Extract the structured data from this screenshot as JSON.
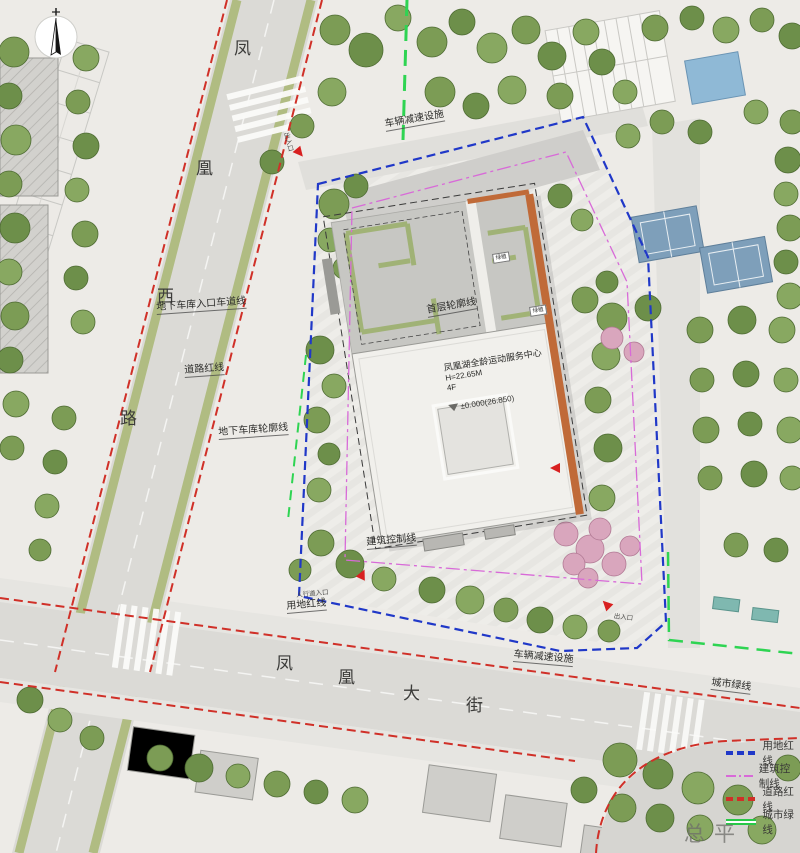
{
  "title": {
    "text": "总平面图",
    "scale": "1:500"
  },
  "roads": {
    "west": [
      "凤",
      "凰",
      "西",
      "路"
    ],
    "south": [
      "凤",
      "凰",
      "大",
      "街"
    ]
  },
  "building": {
    "name": "凤凰湖全龄运动服务中心",
    "height": "H=22.65M",
    "floors": "4F",
    "elevation": "±0.000(26.850)",
    "roof_labels": [
      "绿植",
      "绿植"
    ]
  },
  "annotations": {
    "speed_bump_top": "车辆减速设施",
    "garage_entry_lane": "地下车库入口车道线",
    "road_red_line": "道路红线",
    "garage_outline": "地下车库轮廓线",
    "first_floor_outline": "首层轮廓线",
    "building_control_line": "建筑控制线",
    "pedestrian_entry": "人行道入口",
    "site_red_line": "用地红线",
    "speed_bump_bottom": "车辆减速设施",
    "city_green_line": "城市绿线",
    "entrance": "出入口"
  },
  "legend": {
    "items": [
      {
        "label": "用地红线",
        "color": "#2038c8"
      },
      {
        "label": "建筑控制线",
        "color": "#d86ad8"
      },
      {
        "label": "道路红线",
        "color": "#d03028"
      },
      {
        "label": "城市绿线",
        "color": "#28c848"
      }
    ]
  },
  "colors": {
    "site_boundary": "#2038c8",
    "control_line": "#d86ad8",
    "road_red": "#d03028",
    "green_line": "#2ed452"
  }
}
